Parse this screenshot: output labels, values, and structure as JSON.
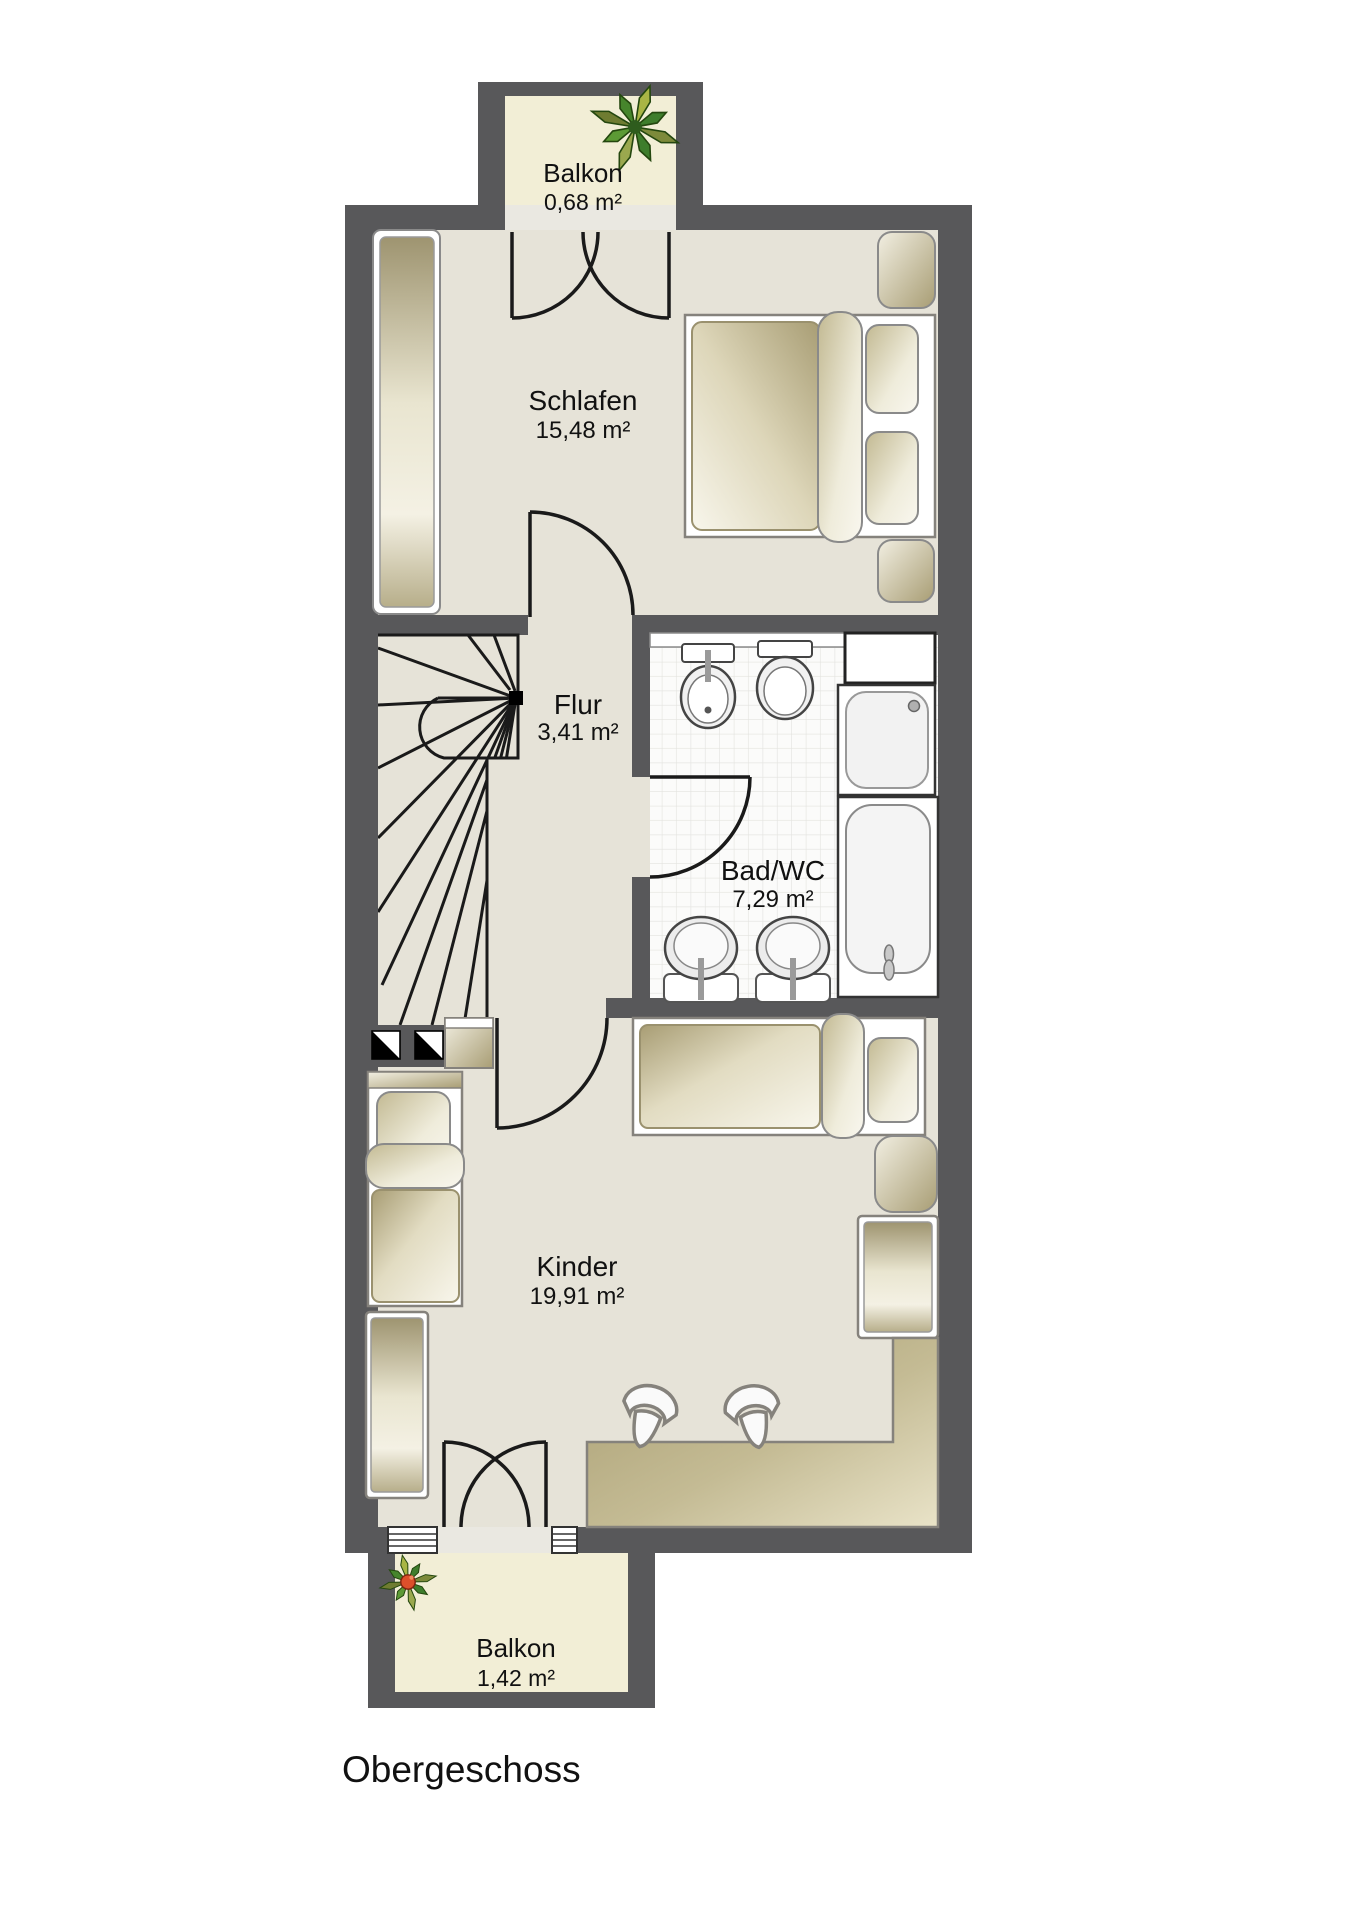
{
  "title": "Obergeschoss",
  "rooms": {
    "balkon_top": {
      "name": "Balkon",
      "area": "0,68 m²"
    },
    "schlafen": {
      "name": "Schlafen",
      "area": "15,48 m²"
    },
    "flur": {
      "name": "Flur",
      "area": "3,41 m²"
    },
    "bad": {
      "name": "Bad/WC",
      "area": "7,29 m²"
    },
    "kinder": {
      "name": "Kinder",
      "area": "19,91 m²"
    },
    "balkon_bottom": {
      "name": "Balkon",
      "area": "1,42 m²"
    }
  },
  "colors": {
    "wall": "#58585a",
    "room_floor": "#e6e3d8",
    "balcony_floor": "#f2eed6",
    "threshold": "#eae8e1",
    "bath_tile": "#fbfbfa",
    "tile_grid": "#e3e3df",
    "furniture_tan_dark": "#a89d74",
    "furniture_tan_light": "#f7f5e9",
    "line": "#1a1a1a"
  },
  "furniture": {
    "balkon_top": [
      "potted-plant"
    ],
    "schlafen": [
      "wardrobe",
      "double-bed",
      "bedside-cushions",
      "balcony-french-door"
    ],
    "flur": [
      "winder-staircase",
      "shaft-symbols"
    ],
    "bad": [
      "bidet",
      "toilet",
      "cabinet",
      "shower",
      "bathtub",
      "washbasin",
      "washbasin"
    ],
    "kinder": [
      "single-bed",
      "single-bed",
      "nightstand",
      "pouf",
      "wardrobe",
      "wardrobe",
      "desk",
      "chair",
      "chair"
    ],
    "balkon_bottom": [
      "potted-plant",
      "windows",
      "balcony-french-door"
    ]
  }
}
